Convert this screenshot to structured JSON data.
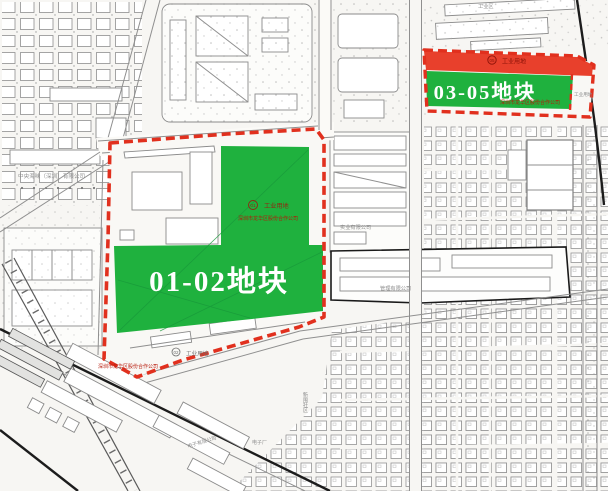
{
  "parcel_01_02": {
    "title": "01-02地块",
    "block_code": "01",
    "block_use": "工业用地",
    "block_owner": "深圳市龙华区股份合作公司",
    "south_code": "02",
    "south_use": "工业用地",
    "south_owner": "深圳市龙华区股份合作公司"
  },
  "parcel_03_05": {
    "title": "03-05地块",
    "band_code": "05",
    "band_use": "工业用地",
    "owner": "深圳市龙华区股份合作公司",
    "side_use": "工业用地"
  },
  "map_labels": {
    "company_left": "中央海味（深圳）有限公司",
    "industrial_zone_top": "工业区",
    "strip_company": "实业有限公司",
    "block_company": "管理有限公司",
    "village_name": "新围社区",
    "factory_a": "电子有限公司",
    "factory_b": "电子厂"
  },
  "colors": {
    "parcel_green": "#1fb13e",
    "boundary_red": "#e1301e",
    "band_red": "#e8402c"
  }
}
